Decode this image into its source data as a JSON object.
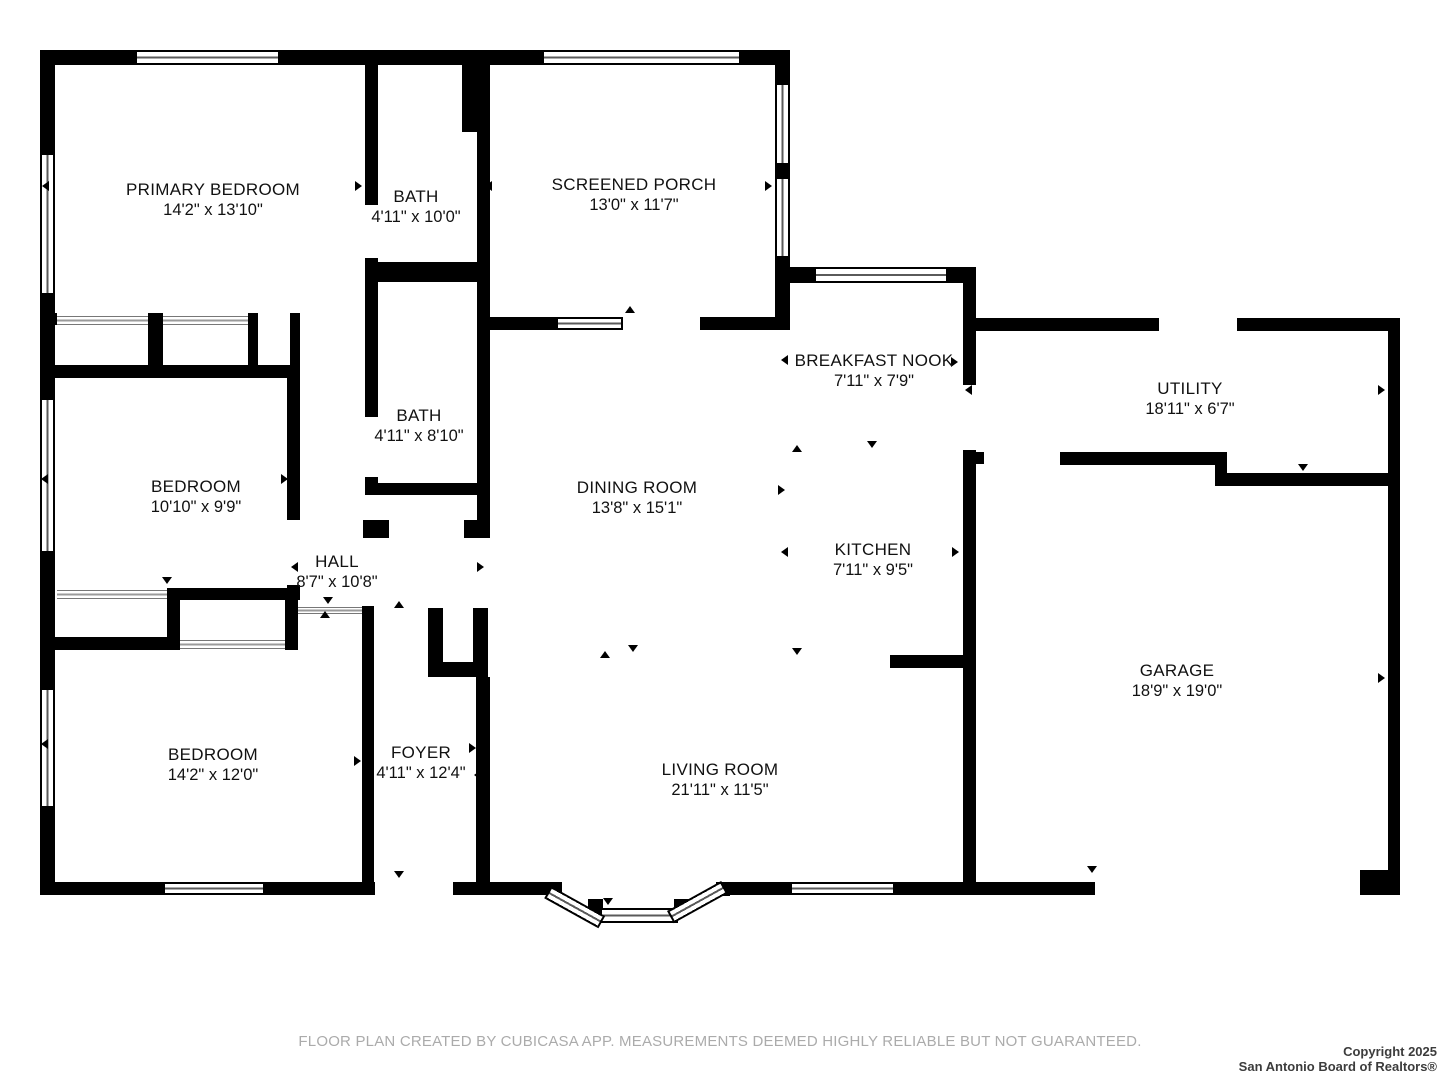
{
  "canvas": {
    "width": 1440,
    "height": 1080,
    "wall_color": "#000000",
    "bg_color": "#ffffff"
  },
  "rooms": [
    {
      "id": "primary-bedroom",
      "name": "PRIMARY BEDROOM",
      "dims": "14'2\" x 13'10\"",
      "cx": 213,
      "cy": 200
    },
    {
      "id": "bath-1",
      "name": "BATH",
      "dims": "4'11\" x 10'0\"",
      "cx": 416,
      "cy": 207
    },
    {
      "id": "screened-porch",
      "name": "SCREENED PORCH",
      "dims": "13'0\" x 11'7\"",
      "cx": 634,
      "cy": 195
    },
    {
      "id": "breakfast-nook",
      "name": "BREAKFAST NOOK",
      "dims": "7'11\" x 7'9\"",
      "cx": 874,
      "cy": 371
    },
    {
      "id": "utility",
      "name": "UTILITY",
      "dims": "18'11\" x 6'7\"",
      "cx": 1190,
      "cy": 399
    },
    {
      "id": "bath-2",
      "name": "BATH",
      "dims": "4'11\" x 8'10\"",
      "cx": 419,
      "cy": 426
    },
    {
      "id": "bedroom-2",
      "name": "BEDROOM",
      "dims": "10'10\" x 9'9\"",
      "cx": 196,
      "cy": 497
    },
    {
      "id": "dining-room",
      "name": "DINING ROOM",
      "dims": "13'8\" x 15'1\"",
      "cx": 637,
      "cy": 498
    },
    {
      "id": "kitchen",
      "name": "KITCHEN",
      "dims": "7'11\" x 9'5\"",
      "cx": 873,
      "cy": 560
    },
    {
      "id": "hall",
      "name": "HALL",
      "dims": "8'7\" x 10'8\"",
      "cx": 337,
      "cy": 572
    },
    {
      "id": "garage",
      "name": "GARAGE",
      "dims": "18'9\" x 19'0\"",
      "cx": 1177,
      "cy": 681
    },
    {
      "id": "bedroom-3",
      "name": "BEDROOM",
      "dims": "14'2\" x 12'0\"",
      "cx": 213,
      "cy": 765
    },
    {
      "id": "foyer",
      "name": "FOYER",
      "dims": "4'11\" x 12'4\"",
      "cx": 421,
      "cy": 763
    },
    {
      "id": "living-room",
      "name": "LIVING ROOM",
      "dims": "21'11\" x 11'5\"",
      "cx": 720,
      "cy": 780
    }
  ],
  "walls": [
    [
      40,
      50,
      15,
      845
    ],
    [
      40,
      50,
      95,
      15
    ],
    [
      280,
      50,
      262,
      15
    ],
    [
      741,
      50,
      49,
      15
    ],
    [
      462,
      50,
      28,
      82
    ],
    [
      697,
      50,
      5,
      15
    ],
    [
      775,
      63,
      15,
      20
    ],
    [
      775,
      165,
      15,
      12
    ],
    [
      775,
      258,
      15,
      72
    ],
    [
      788,
      267,
      26,
      16
    ],
    [
      948,
      267,
      28,
      16
    ],
    [
      876,
      267,
      5,
      16
    ],
    [
      963,
      267,
      13,
      118
    ],
    [
      963,
      450,
      13,
      445
    ],
    [
      973,
      318,
      186,
      13
    ],
    [
      1237,
      318,
      163,
      13
    ],
    [
      1388,
      318,
      12,
      577
    ],
    [
      1060,
      452,
      167,
      13
    ],
    [
      1215,
      452,
      12,
      34
    ],
    [
      1227,
      473,
      161,
      13
    ],
    [
      40,
      882,
      335,
      13
    ],
    [
      453,
      882,
      103,
      13
    ],
    [
      718,
      882,
      72,
      13
    ],
    [
      895,
      882,
      200,
      13
    ],
    [
      1360,
      870,
      28,
      25
    ],
    [
      548,
      882,
      14,
      14
    ],
    [
      716,
      882,
      14,
      14
    ],
    [
      588,
      899,
      15,
      15
    ],
    [
      674,
      899,
      15,
      15
    ],
    [
      365,
      65,
      13,
      140
    ],
    [
      365,
      258,
      13,
      27
    ],
    [
      365,
      262,
      125,
      20
    ],
    [
      477,
      130,
      13,
      135
    ],
    [
      477,
      262,
      13,
      276
    ],
    [
      365,
      285,
      13,
      132
    ],
    [
      365,
      477,
      13,
      18
    ],
    [
      365,
      483,
      125,
      12
    ],
    [
      363,
      520,
      26,
      18
    ],
    [
      464,
      520,
      26,
      18
    ],
    [
      483,
      317,
      75,
      13
    ],
    [
      700,
      317,
      90,
      13
    ],
    [
      48,
      313,
      9,
      12
    ],
    [
      148,
      313,
      15,
      64
    ],
    [
      248,
      313,
      10,
      64
    ],
    [
      290,
      313,
      10,
      65
    ],
    [
      40,
      365,
      260,
      13
    ],
    [
      287,
      378,
      13,
      142
    ],
    [
      287,
      585,
      13,
      15
    ],
    [
      167,
      588,
      131,
      12
    ],
    [
      167,
      588,
      13,
      62
    ],
    [
      285,
      588,
      13,
      62
    ],
    [
      40,
      637,
      140,
      13
    ],
    [
      362,
      606,
      12,
      276
    ],
    [
      428,
      608,
      15,
      69
    ],
    [
      473,
      608,
      15,
      69
    ],
    [
      428,
      662,
      60,
      15
    ],
    [
      476,
      677,
      14,
      205
    ],
    [
      890,
      655,
      86,
      13
    ],
    [
      975,
      452,
      9,
      12
    ]
  ],
  "windows": [
    {
      "x": 135,
      "y": 50,
      "w": 145,
      "h": 15,
      "o": "h"
    },
    {
      "x": 542,
      "y": 50,
      "w": 199,
      "h": 15,
      "o": "h"
    },
    {
      "x": 775,
      "y": 83,
      "w": 15,
      "h": 82,
      "o": "v"
    },
    {
      "x": 775,
      "y": 177,
      "w": 15,
      "h": 81,
      "o": "v"
    },
    {
      "x": 40,
      "y": 153,
      "w": 15,
      "h": 142,
      "o": "v"
    },
    {
      "x": 40,
      "y": 398,
      "w": 15,
      "h": 155,
      "o": "v"
    },
    {
      "x": 40,
      "y": 688,
      "w": 15,
      "h": 120,
      "o": "v"
    },
    {
      "x": 814,
      "y": 267,
      "w": 134,
      "h": 16,
      "o": "h"
    },
    {
      "x": 556,
      "y": 317,
      "w": 67,
      "h": 13,
      "o": "h"
    },
    {
      "x": 163,
      "y": 882,
      "w": 102,
      "h": 13,
      "o": "h"
    },
    {
      "x": 790,
      "y": 882,
      "w": 105,
      "h": 13,
      "o": "h"
    },
    {
      "x": 600,
      "y": 908,
      "w": 78,
      "h": 15,
      "o": "h"
    },
    {
      "x": 551,
      "y": 886,
      "w": 62,
      "h": 14,
      "o": "h",
      "rot": 29
    },
    {
      "x": 667,
      "y": 911,
      "w": 62,
      "h": 14,
      "o": "h",
      "rot": -29
    }
  ],
  "closet_doors": [
    [
      57,
      316,
      91,
      9
    ],
    [
      163,
      316,
      85,
      9
    ],
    [
      57,
      590,
      110,
      9
    ],
    [
      180,
      640,
      105,
      9
    ],
    [
      298,
      607,
      64,
      7
    ]
  ],
  "door_markers": [
    {
      "x": 330,
      "y": 60,
      "dir": "up"
    },
    {
      "x": 420,
      "y": 60,
      "dir": "up"
    },
    {
      "x": 47,
      "y": 186,
      "dir": "left"
    },
    {
      "x": 360,
      "y": 186,
      "dir": "right"
    },
    {
      "x": 373,
      "y": 200,
      "dir": "left"
    },
    {
      "x": 490,
      "y": 186,
      "dir": "left"
    },
    {
      "x": 770,
      "y": 186,
      "dir": "right"
    },
    {
      "x": 630,
      "y": 311,
      "dir": "up"
    },
    {
      "x": 786,
      "y": 360,
      "dir": "left"
    },
    {
      "x": 956,
      "y": 362,
      "dir": "right"
    },
    {
      "x": 970,
      "y": 390,
      "dir": "left"
    },
    {
      "x": 1303,
      "y": 327,
      "dir": "down"
    },
    {
      "x": 1383,
      "y": 390,
      "dir": "right"
    },
    {
      "x": 1095,
      "y": 459,
      "dir": "up"
    },
    {
      "x": 1303,
      "y": 469,
      "dir": "down"
    },
    {
      "x": 797,
      "y": 450,
      "dir": "up"
    },
    {
      "x": 872,
      "y": 446,
      "dir": "down"
    },
    {
      "x": 783,
      "y": 490,
      "dir": "right"
    },
    {
      "x": 786,
      "y": 552,
      "dir": "left"
    },
    {
      "x": 957,
      "y": 552,
      "dir": "right"
    },
    {
      "x": 797,
      "y": 653,
      "dir": "down"
    },
    {
      "x": 633,
      "y": 650,
      "dir": "down"
    },
    {
      "x": 605,
      "y": 656,
      "dir": "up"
    },
    {
      "x": 46,
      "y": 479,
      "dir": "left"
    },
    {
      "x": 286,
      "y": 479,
      "dir": "right"
    },
    {
      "x": 168,
      "y": 372,
      "dir": "up"
    },
    {
      "x": 167,
      "y": 582,
      "dir": "down"
    },
    {
      "x": 296,
      "y": 567,
      "dir": "left"
    },
    {
      "x": 482,
      "y": 567,
      "dir": "right"
    },
    {
      "x": 328,
      "y": 602,
      "dir": "down"
    },
    {
      "x": 325,
      "y": 616,
      "dir": "up"
    },
    {
      "x": 399,
      "y": 606,
      "dir": "up"
    },
    {
      "x": 46,
      "y": 744,
      "dir": "left"
    },
    {
      "x": 368,
      "y": 749,
      "dir": "left"
    },
    {
      "x": 359,
      "y": 761,
      "dir": "right"
    },
    {
      "x": 474,
      "y": 748,
      "dir": "right"
    },
    {
      "x": 479,
      "y": 775,
      "dir": "left"
    },
    {
      "x": 399,
      "y": 876,
      "dir": "down"
    },
    {
      "x": 608,
      "y": 903,
      "dir": "down"
    },
    {
      "x": 1092,
      "y": 871,
      "dir": "down"
    },
    {
      "x": 1383,
      "y": 678,
      "dir": "right"
    }
  ],
  "footer": {
    "text": "FLOOR PLAN CREATED BY CUBICASA APP. MEASUREMENTS DEEMED HIGHLY RELIABLE BUT NOT GUARANTEED."
  },
  "copyright": {
    "line1": "Copyright 2025",
    "line2": "San Antonio Board of Realtors®"
  }
}
